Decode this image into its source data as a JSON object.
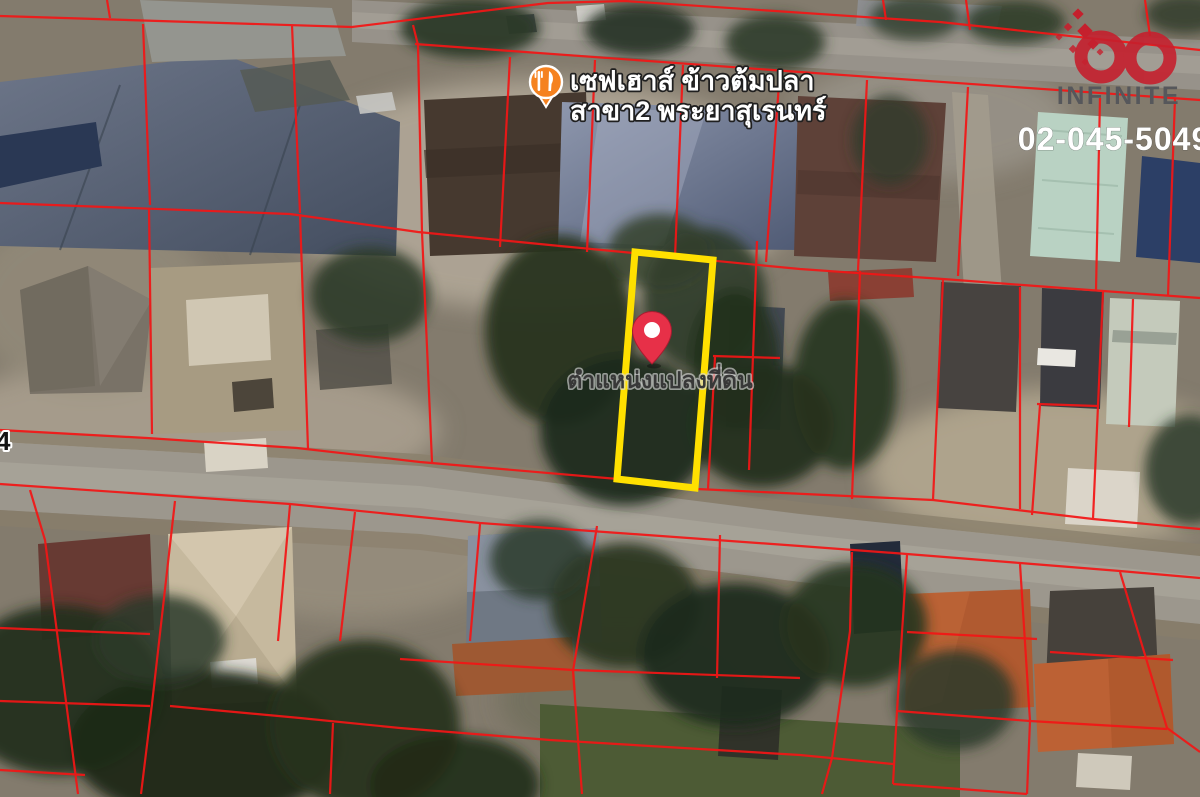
{
  "map": {
    "type": "satellite",
    "road_label": {
      "text": "4"
    },
    "poi": {
      "icon": "restaurant-pin-icon",
      "icon_color": "#f58220",
      "label_line1": "เซฟเฮาส์ ข้าวต้มปลา",
      "label_line2": "สาขา2 พระยาสุเรนทร์",
      "label_color": "#ffffff"
    },
    "marker": {
      "icon": "location-pin-icon",
      "pin_color": "#e73048",
      "label": "ตำแหน่งแปลงที่ดิน",
      "label_color": "#3a3a3a"
    },
    "highlight_parcel": {
      "outline_color": "#ffe000"
    },
    "cadastral_overlay": {
      "line_color": "#f31616"
    }
  },
  "watermark": {
    "logo_icon": "infinity-logo-icon",
    "logo_color": "#c5202d",
    "brand": "INFINITE",
    "brand_color": "#56575b",
    "phone": "02-045-5049",
    "phone_color": "#ffffff"
  }
}
